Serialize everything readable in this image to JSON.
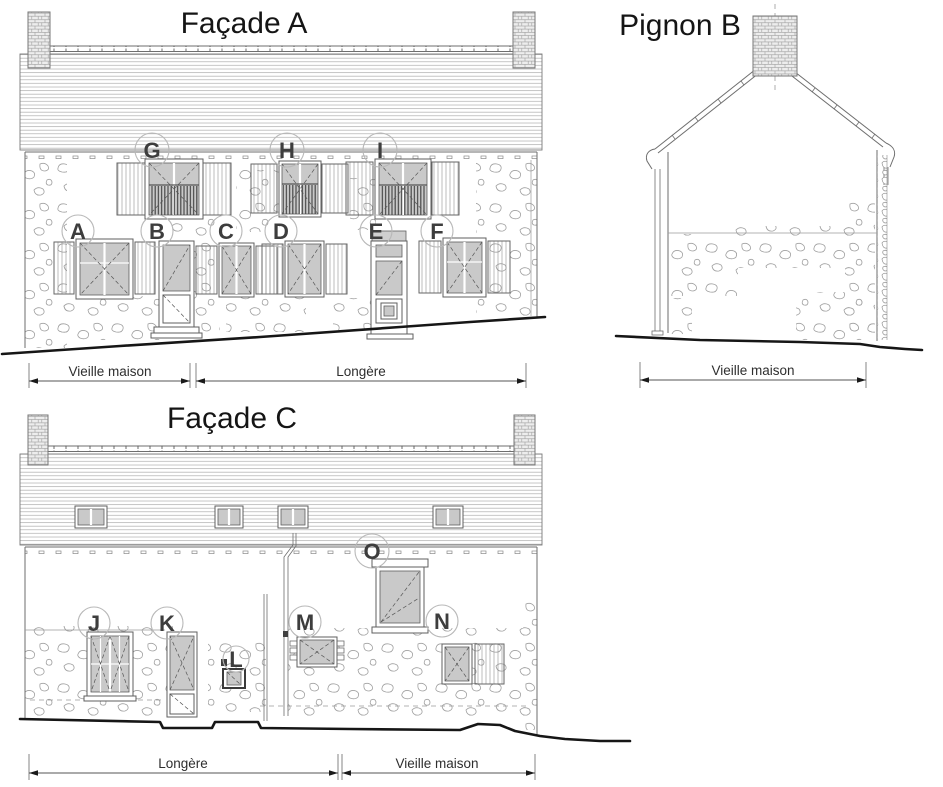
{
  "drawing": {
    "facade_a": {
      "title": "Façade A",
      "upper_openings": [
        {
          "id": "G"
        },
        {
          "id": "H"
        },
        {
          "id": "I"
        }
      ],
      "ground_openings": [
        {
          "id": "A"
        },
        {
          "id": "B"
        },
        {
          "id": "C"
        },
        {
          "id": "D"
        },
        {
          "id": "E"
        },
        {
          "id": "F"
        }
      ],
      "dimensions": [
        {
          "label": "Vieille maison"
        },
        {
          "label": "Longère"
        }
      ]
    },
    "pignon_b": {
      "title": "Pignon B",
      "dimensions": [
        {
          "label": "Vieille maison"
        }
      ]
    },
    "facade_c": {
      "title": "Façade C",
      "openings": [
        {
          "id": "J"
        },
        {
          "id": "K"
        },
        {
          "id": "L"
        },
        {
          "id": "M"
        },
        {
          "id": "N"
        },
        {
          "id": "O"
        }
      ],
      "dimensions": [
        {
          "label": "Longère"
        },
        {
          "label": "Vieille maison"
        }
      ]
    }
  },
  "colors": {
    "line": "#6e6e6e",
    "line_light": "#9a9a9a",
    "ground": "#161616",
    "glazing": "#c9c9c9",
    "label": "#3d3d3d",
    "title": "#151515",
    "dimension": "#2e2e2e",
    "circle": "#b8b8b8"
  }
}
